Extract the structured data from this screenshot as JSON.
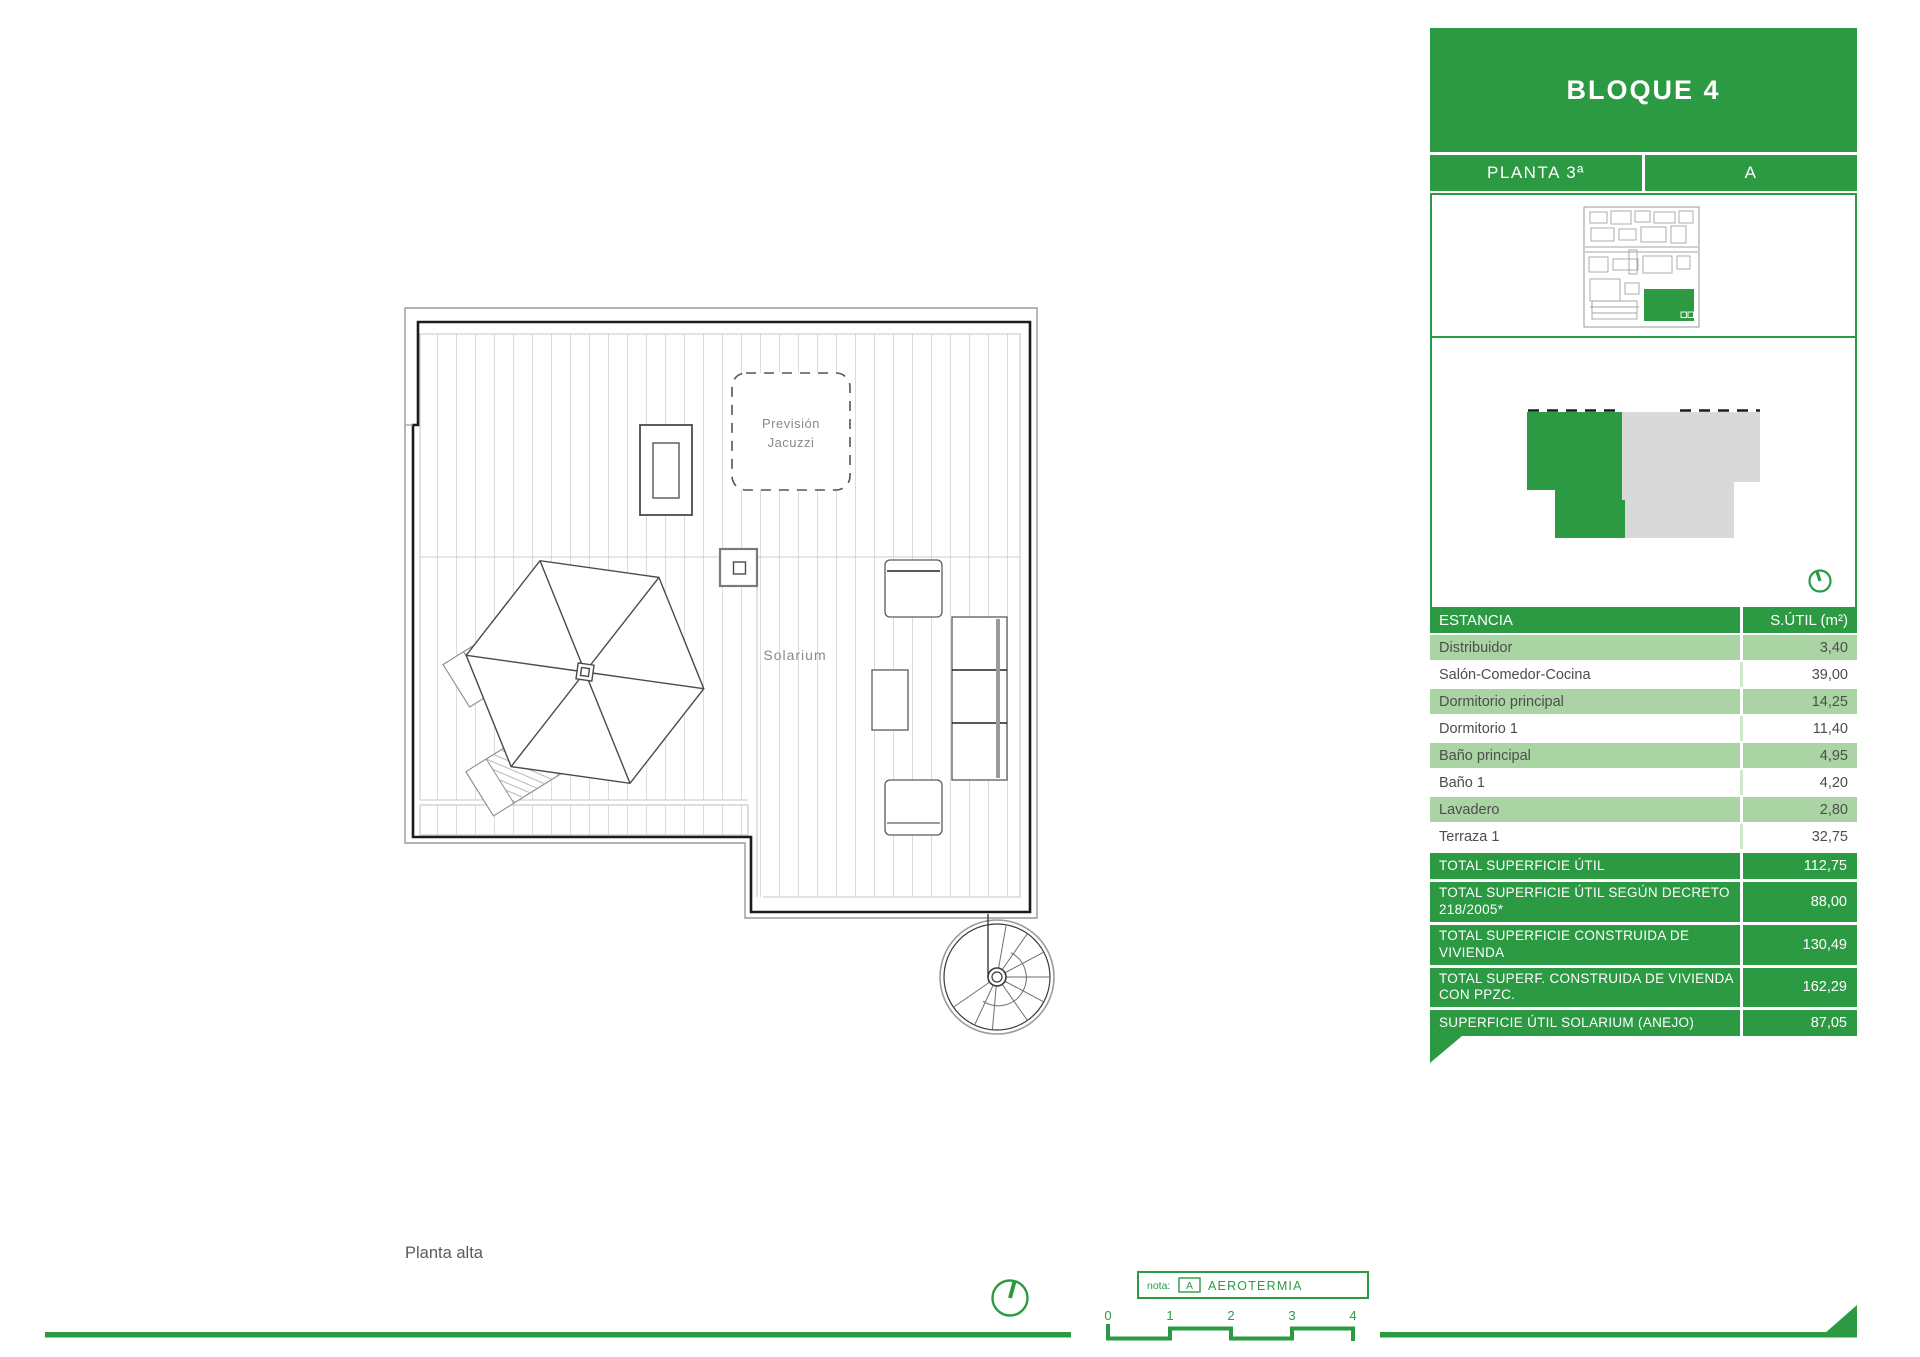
{
  "panel": {
    "title": "BLOQUE 4",
    "floor_label": "PLANTA 3ª",
    "unit_label": "A",
    "table": {
      "col_room": "ESTANCIA",
      "col_area": "S.ÚTIL (m²)",
      "rows": [
        {
          "room": "Distribuidor",
          "area": "3,40"
        },
        {
          "room": "Salón-Comedor-Cocina",
          "area": "39,00"
        },
        {
          "room": "Dormitorio principal",
          "area": "14,25"
        },
        {
          "room": "Dormitorio 1",
          "area": "11,40"
        },
        {
          "room": "Baño principal",
          "area": "4,95"
        },
        {
          "room": "Baño 1",
          "area": "4,20"
        },
        {
          "room": "Lavadero",
          "area": "2,80"
        },
        {
          "room": "Terraza 1",
          "area": "32,75"
        }
      ],
      "totals": [
        {
          "label": "TOTAL SUPERFICIE ÚTIL",
          "value": "112,75"
        },
        {
          "label": "TOTAL SUPERFICIE ÚTIL SEGÚN DECRETO 218/2005*",
          "value": "88,00"
        },
        {
          "label": "TOTAL SUPERFICIE CONSTRUIDA DE VIVIENDA",
          "value": "130,49"
        },
        {
          "label": "TOTAL SUPERF. CONSTRUIDA DE VIVIENDA CON PPZC.",
          "value": "162,29"
        },
        {
          "label": "SUPERFICIE ÚTIL SOLARIUM (ANEJO)",
          "value": "87,05"
        }
      ]
    }
  },
  "plan": {
    "jacuzzi_line1": "Previsión",
    "jacuzzi_line2": "Jacuzzi",
    "solarium": "Solarium",
    "floor_name": "Planta alta"
  },
  "footer": {
    "note_prefix": "nota:",
    "note_key": "A",
    "note_text": "AEROTERMIA",
    "scale_ticks": [
      "0",
      "1",
      "2",
      "3",
      "4"
    ]
  },
  "colors": {
    "green": "#2B9A43",
    "light_green": "#AAD4A4",
    "gray_unit": "#D9D9D9",
    "text_gray": "#4D4D4D"
  }
}
